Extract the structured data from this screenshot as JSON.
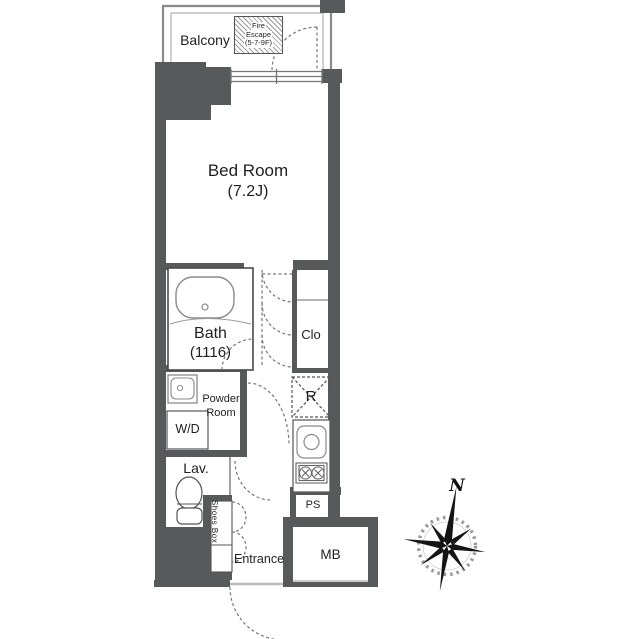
{
  "colors": {
    "wall": "#58595b",
    "outline": "#4a4a4a",
    "fixture": "#8a8a8a",
    "dash": "#777777",
    "text": "#1f1f1f"
  },
  "rooms": {
    "balcony": "Balcony",
    "fire_escape_1": "Fire",
    "fire_escape_2": "Escape",
    "fire_escape_3": "(5-7-9F)",
    "bedroom_1": "Bed Room",
    "bedroom_2": "(7.2J)",
    "bath_1": "Bath",
    "bath_2": "(1116)",
    "closet": "Clo",
    "powder_1": "Powder",
    "powder_2": "Room",
    "washer_dryer": "W/D",
    "refrigerator": "R",
    "lavatory": "Lav.",
    "shoes_1": "Shoes",
    "shoes_2": "Box",
    "entrance": "Entrance",
    "pipe_space": "PS",
    "meter_box": "MB",
    "compass_north": "N"
  }
}
